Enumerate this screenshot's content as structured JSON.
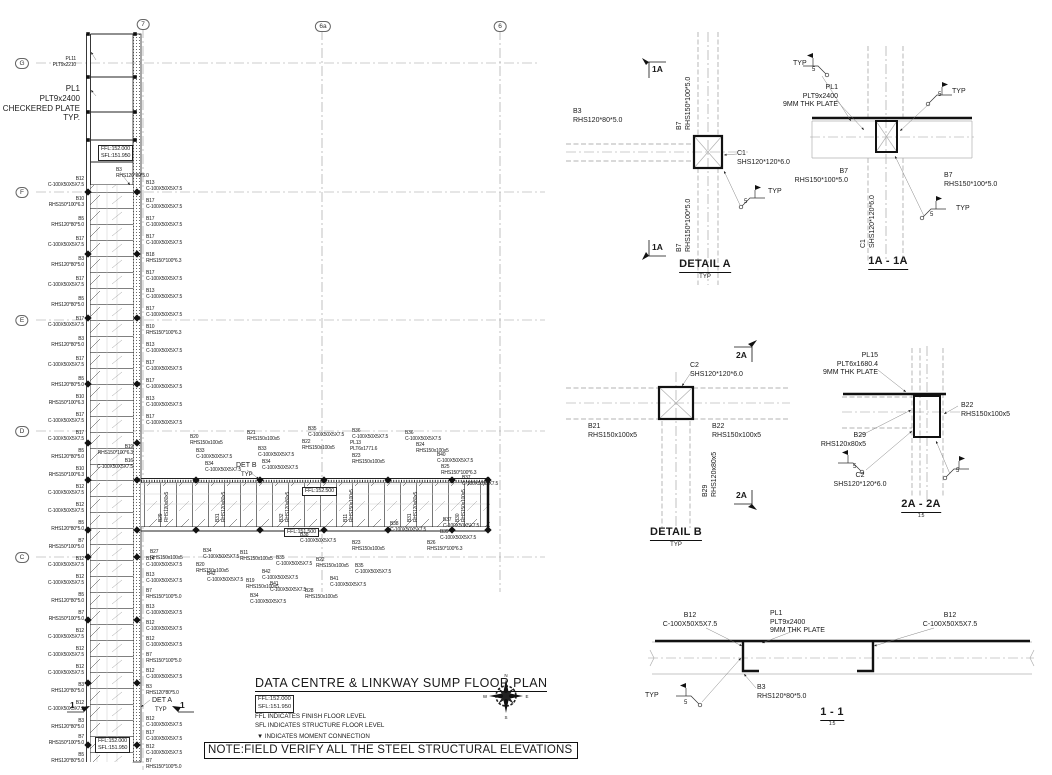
{
  "sheet": {
    "title": "DATA CENTRE & LINKWAY SUMP FLOOR PLAN",
    "level_box": "FFL:152.000\nSFL:151.950",
    "legend_ffl": "FFL INDICATES FINISH FLOOR LEVEL",
    "legend_sfl": "SFL INDICATES STRUCTURE FLOOR LEVEL",
    "legend_moment": "▼ INDICATES MOMENT CONNECTION",
    "note": "NOTE:FIELD VERIFY ALL THE STEEL STRUCTURAL ELEVATIONS"
  },
  "compass": {
    "n": "N",
    "e": "E",
    "s": "S",
    "w": "W"
  },
  "annotations": [
    {
      "n": "grid-bubble-7",
      "x": 143,
      "y": 19,
      "a": "c",
      "cls": "bubble",
      "t": "7"
    },
    {
      "n": "grid-bubble-6a",
      "x": 323,
      "y": 21,
      "a": "c",
      "cls": "bubble",
      "t": "6a"
    },
    {
      "n": "grid-bubble-6",
      "x": 500,
      "y": 21,
      "a": "c",
      "cls": "bubble",
      "t": "6"
    },
    {
      "n": "grid-bubble-g",
      "x": 22,
      "y": 58,
      "a": "c",
      "cls": "bubble",
      "t": "G"
    },
    {
      "n": "grid-bubble-f",
      "x": 22,
      "y": 187,
      "a": "c",
      "cls": "bubble",
      "t": "F"
    },
    {
      "n": "grid-bubble-e",
      "x": 22,
      "y": 315,
      "a": "c",
      "cls": "bubble",
      "t": "E"
    },
    {
      "n": "grid-bubble-d",
      "x": 22,
      "y": 426,
      "a": "c",
      "cls": "bubble",
      "t": "D"
    },
    {
      "n": "grid-bubble-c",
      "x": 22,
      "y": 552,
      "a": "c",
      "cls": "bubble",
      "t": "C"
    },
    {
      "x": 76,
      "y": 56,
      "a": "r",
      "t": "PL11\nPLT9x2210"
    },
    {
      "n": "checkered-plate-note",
      "x": 80,
      "y": 84,
      "a": "r",
      "cls": "c8",
      "t": "PL1\nPLT9x2400\nCHECKERED PLATE\nTYP."
    },
    {
      "n": "level-box",
      "x": 98,
      "y": 145,
      "cls": "lvlbox",
      "t": "FFL:152.000\nSFL:151.950"
    },
    {
      "n": "level-box",
      "x": 302,
      "y": 487,
      "cls": "lvlbox",
      "t": "FFL:152.500"
    },
    {
      "n": "level-box",
      "x": 284,
      "y": 528,
      "cls": "lvlbox",
      "t": "FFL:151.500"
    },
    {
      "n": "level-box",
      "x": 95,
      "y": 737,
      "cls": "lvlbox",
      "t": "FFL:152.000\nSFL:151.950"
    },
    {
      "x": 116,
      "y": 167,
      "t": "B3\nRHS120*80*5.0"
    },
    {
      "x": 84,
      "y": 176,
      "a": "r",
      "t": "B12\nC-100X50X5X7.5"
    },
    {
      "x": 84,
      "y": 196,
      "a": "r",
      "t": "B10\nRHS150*100*6.3"
    },
    {
      "x": 84,
      "y": 216,
      "a": "r",
      "t": "B5\nRHS120*80*5.0"
    },
    {
      "x": 84,
      "y": 236,
      "a": "r",
      "t": "B17\nC-100X50X5X7.5"
    },
    {
      "x": 84,
      "y": 256,
      "a": "r",
      "t": "B3\nRHS120*80*5.0"
    },
    {
      "x": 84,
      "y": 276,
      "a": "r",
      "t": "B17\nC-100X50X5X7.5"
    },
    {
      "x": 84,
      "y": 296,
      "a": "r",
      "t": "B5\nRHS120*80*5.0"
    },
    {
      "x": 84,
      "y": 316,
      "a": "r",
      "t": "B17\nC-100X50X5X7.5"
    },
    {
      "x": 84,
      "y": 336,
      "a": "r",
      "t": "B3\nRHS120*80*5.0"
    },
    {
      "x": 84,
      "y": 356,
      "a": "r",
      "t": "B17\nC-100X50X5X7.5"
    },
    {
      "x": 84,
      "y": 376,
      "a": "r",
      "t": "B5\nRHS120*80*5.0"
    },
    {
      "x": 84,
      "y": 394,
      "a": "r",
      "t": "B10\nRHS150*100*6.3"
    },
    {
      "x": 84,
      "y": 412,
      "a": "r",
      "t": "B17\nC-100X50X5X7.5"
    },
    {
      "x": 84,
      "y": 430,
      "a": "r",
      "t": "B17\nC-100X50X5X7.5"
    },
    {
      "x": 84,
      "y": 448,
      "a": "r",
      "t": "B5\nRHS120*80*5.0"
    },
    {
      "x": 84,
      "y": 466,
      "a": "r",
      "t": "B10\nRHS150*100*6.3"
    },
    {
      "x": 84,
      "y": 484,
      "a": "r",
      "t": "B12\nC-100X50X5X7.5"
    },
    {
      "x": 84,
      "y": 502,
      "a": "r",
      "t": "B12\nC-100X50X5X7.5"
    },
    {
      "x": 84,
      "y": 520,
      "a": "r",
      "t": "B5\nRHS120*80*5.0"
    },
    {
      "x": 84,
      "y": 538,
      "a": "r",
      "t": "B7\nRHS150*100*5.0"
    },
    {
      "x": 84,
      "y": 556,
      "a": "r",
      "t": "B12\nC-100X50X5X7.5"
    },
    {
      "x": 84,
      "y": 574,
      "a": "r",
      "t": "B12\nC-100X50X5X7.5"
    },
    {
      "x": 84,
      "y": 592,
      "a": "r",
      "t": "B5\nRHS120*80*5.0"
    },
    {
      "x": 84,
      "y": 610,
      "a": "r",
      "t": "B7\nRHS150*100*5.0"
    },
    {
      "x": 84,
      "y": 628,
      "a": "r",
      "t": "B12\nC-100X50X5X7.5"
    },
    {
      "x": 84,
      "y": 646,
      "a": "r",
      "t": "B12\nC-100X50X5X7.5"
    },
    {
      "x": 84,
      "y": 664,
      "a": "r",
      "t": "B12\nC-100X50X5X7.5"
    },
    {
      "x": 84,
      "y": 682,
      "a": "r",
      "t": "B3\nRHS120*80*5.0"
    },
    {
      "x": 84,
      "y": 700,
      "a": "r",
      "t": "B12\nC-100X50X5X7.5"
    },
    {
      "x": 84,
      "y": 718,
      "a": "r",
      "t": "B3\nRHS120*80*5.0"
    },
    {
      "x": 84,
      "y": 734,
      "a": "r",
      "t": "B7\nRHS150*100*5.0"
    },
    {
      "x": 84,
      "y": 752,
      "a": "r",
      "t": "B5\nRHS120*80*5.0"
    },
    {
      "x": 146,
      "y": 180,
      "t": "B13\nC-100X50X5X7.5"
    },
    {
      "x": 146,
      "y": 198,
      "t": "B17\nC-100X50X5X7.5"
    },
    {
      "x": 146,
      "y": 216,
      "t": "B17\nC-100X50X5X7.5"
    },
    {
      "x": 146,
      "y": 234,
      "t": "B17\nC-100X50X5X7.5"
    },
    {
      "x": 146,
      "y": 252,
      "t": "B18\nRHS150*100*6.3"
    },
    {
      "x": 146,
      "y": 270,
      "t": "B17\nC-100X50X5X7.5"
    },
    {
      "x": 146,
      "y": 288,
      "t": "B13\nC-100X50X5X7.5"
    },
    {
      "x": 146,
      "y": 306,
      "t": "B17\nC-100X50X5X7.5"
    },
    {
      "x": 146,
      "y": 324,
      "t": "B10\nRHS150*100*6.3"
    },
    {
      "x": 146,
      "y": 342,
      "t": "B13\nC-100X50X5X7.5"
    },
    {
      "x": 146,
      "y": 360,
      "t": "B17\nC-100X50X5X7.5"
    },
    {
      "x": 146,
      "y": 378,
      "t": "B17\nC-100X50X5X7.5"
    },
    {
      "x": 146,
      "y": 396,
      "t": "B13\nC-100X50X5X7.5"
    },
    {
      "x": 146,
      "y": 414,
      "t": "B17\nC-100X50X5X7.5"
    },
    {
      "x": 146,
      "y": 556,
      "t": "B14\nC-100X50X5X7.5"
    },
    {
      "x": 146,
      "y": 572,
      "t": "B13\nC-100X50X5X7.5"
    },
    {
      "x": 146,
      "y": 588,
      "t": "B7\nRHS150*100*5.0"
    },
    {
      "x": 146,
      "y": 604,
      "t": "B13\nC-100X50X5X7.5"
    },
    {
      "x": 146,
      "y": 620,
      "t": "B12\nC-100X50X5X7.5"
    },
    {
      "x": 146,
      "y": 636,
      "t": "B12\nC-100X50X5X7.5"
    },
    {
      "x": 146,
      "y": 652,
      "t": "B7\nRHS150*100*5.0"
    },
    {
      "x": 146,
      "y": 668,
      "t": "B12\nC-100X50X5X7.5"
    },
    {
      "x": 146,
      "y": 684,
      "t": "B3\nRHS120*80*5.0"
    },
    {
      "x": 146,
      "y": 716,
      "t": "B12\nC-100X50X5X7.5"
    },
    {
      "x": 146,
      "y": 730,
      "t": "B17\nC-100X50X5X7.5"
    },
    {
      "x": 146,
      "y": 744,
      "t": "B12\nC-100X50X5X7.5"
    },
    {
      "x": 146,
      "y": 758,
      "t": "B7\nRHS150*100*5.0"
    },
    {
      "x": 133,
      "y": 444,
      "a": "r",
      "t": "B19\nRHS150*100*6.3"
    },
    {
      "x": 133,
      "y": 458,
      "a": "r",
      "t": "B16\nC-100X50X5X7.5"
    },
    {
      "x": 190,
      "y": 434,
      "t": "B20\nRHS150x100x5"
    },
    {
      "x": 196,
      "y": 448,
      "t": "B33\nC-100X50X5X7.5"
    },
    {
      "x": 247,
      "y": 430,
      "t": "B21\nRHS150x100x5"
    },
    {
      "x": 205,
      "y": 461,
      "t": "B34\nC-100X50X5X7.5"
    },
    {
      "x": 258,
      "y": 446,
      "t": "B33\nC-100X50X5X7.5"
    },
    {
      "x": 262,
      "y": 459,
      "t": "B34\nC-100X50X5X7.5"
    },
    {
      "n": "det-b-ref",
      "x": 236,
      "y": 462,
      "cls": "c7",
      "t": "DET B"
    },
    {
      "x": 241,
      "y": 472,
      "cls": "c6",
      "t": "TYP"
    },
    {
      "x": 308,
      "y": 426,
      "t": "B35\nC-100X50X5X7.5"
    },
    {
      "x": 302,
      "y": 439,
      "t": "B22\nRHS150x100x5"
    },
    {
      "x": 352,
      "y": 428,
      "t": "B36\nC-100X50X5X7.5"
    },
    {
      "x": 350,
      "y": 440,
      "t": "PL13\nPLT6x1771.6"
    },
    {
      "x": 352,
      "y": 453,
      "t": "B23\nRHS150x100x5"
    },
    {
      "x": 405,
      "y": 430,
      "t": "B36\nC-100X50X5X7.5"
    },
    {
      "x": 416,
      "y": 442,
      "t": "B24\nRHS150x100x5"
    },
    {
      "x": 437,
      "y": 452,
      "t": "B40\nC-100X50X5X7.5"
    },
    {
      "x": 441,
      "y": 464,
      "t": "B25\nRHS150*100*6.3"
    },
    {
      "x": 462,
      "y": 475,
      "t": "B37\nC-100X50X5X7.5"
    },
    {
      "x": 158,
      "y": 522,
      "r": -90,
      "t": "B29\nRHS120x80x5"
    },
    {
      "x": 215,
      "y": 522,
      "r": -90,
      "t": "B31\nRHS120x80x5"
    },
    {
      "x": 279,
      "y": 522,
      "r": -90,
      "t": "B32\nRHS120x80x5"
    },
    {
      "x": 343,
      "y": 522,
      "r": -90,
      "t": "B11\nRHS150x100x5"
    },
    {
      "x": 407,
      "y": 522,
      "r": -90,
      "t": "B31\nRHS120x80x5"
    },
    {
      "x": 455,
      "y": 522,
      "r": -90,
      "t": "B30\nRHS150x100x5"
    },
    {
      "x": 150,
      "y": 549,
      "t": "B27\nRHS150x100x5"
    },
    {
      "x": 203,
      "y": 548,
      "t": "B34\nC-100X50X5X7.5"
    },
    {
      "x": 240,
      "y": 550,
      "t": "B11\nRHS150x100x5"
    },
    {
      "x": 276,
      "y": 555,
      "t": "B35\nC-100X50X5X7.5"
    },
    {
      "x": 316,
      "y": 557,
      "t": "B22\nRHS150x100x5"
    },
    {
      "x": 196,
      "y": 562,
      "t": "B20\nRHS150x100x5"
    },
    {
      "x": 207,
      "y": 571,
      "t": "B42\nC-100X50X5X7.5"
    },
    {
      "x": 246,
      "y": 578,
      "t": "B19\nRHS150x100x5"
    },
    {
      "x": 262,
      "y": 569,
      "t": "B42\nC-100X50X5X7.5"
    },
    {
      "x": 270,
      "y": 581,
      "t": "B41\nC-100X50X5X7.5"
    },
    {
      "x": 250,
      "y": 593,
      "t": "B34\nC-100X50X5X7.5"
    },
    {
      "x": 305,
      "y": 588,
      "t": "B28\nRHS150x100x5"
    },
    {
      "x": 330,
      "y": 576,
      "t": "B41\nC-100X50X5X7.5"
    },
    {
      "x": 355,
      "y": 563,
      "t": "B35\nC-100X50X5X7.5"
    },
    {
      "x": 390,
      "y": 521,
      "t": "B38\nC-100X50X5X7.5"
    },
    {
      "x": 443,
      "y": 517,
      "t": "B37\nC-100X50X5X7.5"
    },
    {
      "x": 352,
      "y": 540,
      "t": "B23\nRHS150x100x5"
    },
    {
      "x": 300,
      "y": 532,
      "t": "B38\nC-100X50X5X7.5"
    },
    {
      "x": 440,
      "y": 529,
      "t": "B39\nC-100X50X5X7.5"
    },
    {
      "x": 427,
      "y": 540,
      "t": "B26\nRHS150*100*6.3"
    },
    {
      "n": "det-a-ref",
      "x": 152,
      "y": 697,
      "cls": "c7",
      "t": "DET A"
    },
    {
      "x": 155,
      "y": 707,
      "cls": "c6",
      "t": "TYP"
    },
    {
      "n": "section-1-marker",
      "x": 70,
      "y": 700,
      "cls": "sec",
      "t": "1"
    },
    {
      "n": "section-1-marker",
      "x": 180,
      "y": 700,
      "cls": "sec",
      "t": "1"
    },
    {
      "n": "section-1a-marker",
      "x": 652,
      "y": 64,
      "cls": "sec",
      "t": "1A"
    },
    {
      "n": "section-1a-marker",
      "x": 652,
      "y": 242,
      "cls": "sec",
      "t": "1A"
    },
    {
      "x": 676,
      "y": 130,
      "r": -90,
      "cls": "c7",
      "t": "B7\nRHS150*100*5.0"
    },
    {
      "x": 676,
      "y": 252,
      "r": -90,
      "cls": "c7",
      "t": "B7\nRHS150*100*5.0"
    },
    {
      "x": 573,
      "y": 108,
      "cls": "c7",
      "t": "B3\nRHS120*80*5.0"
    },
    {
      "x": 737,
      "y": 150,
      "cls": "c7",
      "t": "C1\nSHS120*120*6.0"
    },
    {
      "x": 744,
      "y": 199,
      "cls": "c6",
      "t": "5"
    },
    {
      "x": 768,
      "y": 188,
      "cls": "c7",
      "t": "TYP"
    },
    {
      "n": "detail-a-title",
      "x": 705,
      "y": 258,
      "a": "c",
      "cls": "title",
      "t": "DETAIL A"
    },
    {
      "x": 705,
      "y": 274,
      "a": "c",
      "cls": "c6",
      "t": "TYP"
    },
    {
      "x": 793,
      "y": 60,
      "cls": "c7",
      "t": "TYP"
    },
    {
      "x": 812,
      "y": 67,
      "cls": "c6",
      "t": "5"
    },
    {
      "x": 838,
      "y": 84,
      "a": "r",
      "cls": "c7",
      "t": "PL1\nPLT9x2400\n9MM THK PLATE"
    },
    {
      "x": 938,
      "y": 92,
      "cls": "c6",
      "t": "5"
    },
    {
      "x": 952,
      "y": 88,
      "cls": "c7",
      "t": "TYP"
    },
    {
      "x": 848,
      "y": 168,
      "a": "r",
      "cls": "c7",
      "t": "B7\nRHS150*100*5.0"
    },
    {
      "x": 944,
      "y": 172,
      "cls": "c7",
      "t": "B7\nRHS150*100*5.0"
    },
    {
      "x": 860,
      "y": 248,
      "r": -90,
      "cls": "c7",
      "t": "C1\nSHS120*120*6.0"
    },
    {
      "x": 930,
      "y": 212,
      "cls": "c6",
      "t": "5"
    },
    {
      "x": 956,
      "y": 205,
      "cls": "c7",
      "t": "TYP"
    },
    {
      "n": "section-1a-title",
      "x": 888,
      "y": 255,
      "a": "c",
      "cls": "title",
      "t": "1A - 1A"
    },
    {
      "n": "section-2a-marker",
      "x": 736,
      "y": 350,
      "cls": "sec",
      "t": "2A"
    },
    {
      "n": "section-2a-marker",
      "x": 736,
      "y": 490,
      "cls": "sec",
      "t": "2A"
    },
    {
      "x": 690,
      "y": 362,
      "cls": "c7",
      "t": "C2\nSHS120*120*6.0"
    },
    {
      "x": 588,
      "y": 423,
      "cls": "c7",
      "t": "B21\nRHS150x100x5"
    },
    {
      "x": 712,
      "y": 423,
      "cls": "c7",
      "t": "B22\nRHS150x100x5"
    },
    {
      "x": 702,
      "y": 497,
      "r": -90,
      "cls": "c7",
      "t": "B29\nRHS120x80x5"
    },
    {
      "n": "detail-b-title",
      "x": 676,
      "y": 526,
      "a": "c",
      "cls": "title",
      "t": "DETAIL B"
    },
    {
      "x": 676,
      "y": 542,
      "a": "c",
      "cls": "c6",
      "t": "TYP"
    },
    {
      "x": 878,
      "y": 352,
      "a": "r",
      "cls": "c7",
      "t": "PL15\nPLT6x1680.4\n9MM THK PLATE"
    },
    {
      "x": 961,
      "y": 402,
      "cls": "c7",
      "t": "B22\nRHS150x100x5"
    },
    {
      "x": 866,
      "y": 432,
      "a": "r",
      "cls": "c7",
      "t": "B29\nRHS120x80x5"
    },
    {
      "x": 853,
      "y": 464,
      "cls": "c6",
      "t": "5"
    },
    {
      "x": 860,
      "y": 472,
      "a": "c",
      "cls": "c7",
      "t": "C2\nSHS120*120*6.0"
    },
    {
      "x": 956,
      "y": 468,
      "cls": "c6",
      "t": "5"
    },
    {
      "n": "section-2a-title",
      "x": 921,
      "y": 498,
      "a": "c",
      "cls": "title",
      "t": "2A - 2A"
    },
    {
      "x": 921,
      "y": 513,
      "a": "c",
      "cls": "c5",
      "t": "1:5"
    },
    {
      "x": 690,
      "y": 612,
      "a": "c",
      "cls": "c7",
      "t": "B12\nC-100X50X5X7.5"
    },
    {
      "x": 770,
      "y": 610,
      "cls": "c7",
      "t": "PL1\nPLT9x2400\n9MM THK PLATE"
    },
    {
      "x": 950,
      "y": 612,
      "a": "c",
      "cls": "c7",
      "t": "B12\nC-100X50X5X7.5"
    },
    {
      "x": 757,
      "y": 684,
      "cls": "c7",
      "t": "B3\nRHS120*80*5.0"
    },
    {
      "x": 645,
      "y": 692,
      "cls": "c7",
      "t": "TYP"
    },
    {
      "x": 684,
      "y": 700,
      "cls": "c6",
      "t": "5"
    },
    {
      "n": "section-1-title",
      "x": 832,
      "y": 706,
      "a": "c",
      "cls": "title",
      "t": "1 - 1"
    },
    {
      "x": 832,
      "y": 721,
      "a": "c",
      "cls": "c5",
      "t": "1:5"
    }
  ]
}
